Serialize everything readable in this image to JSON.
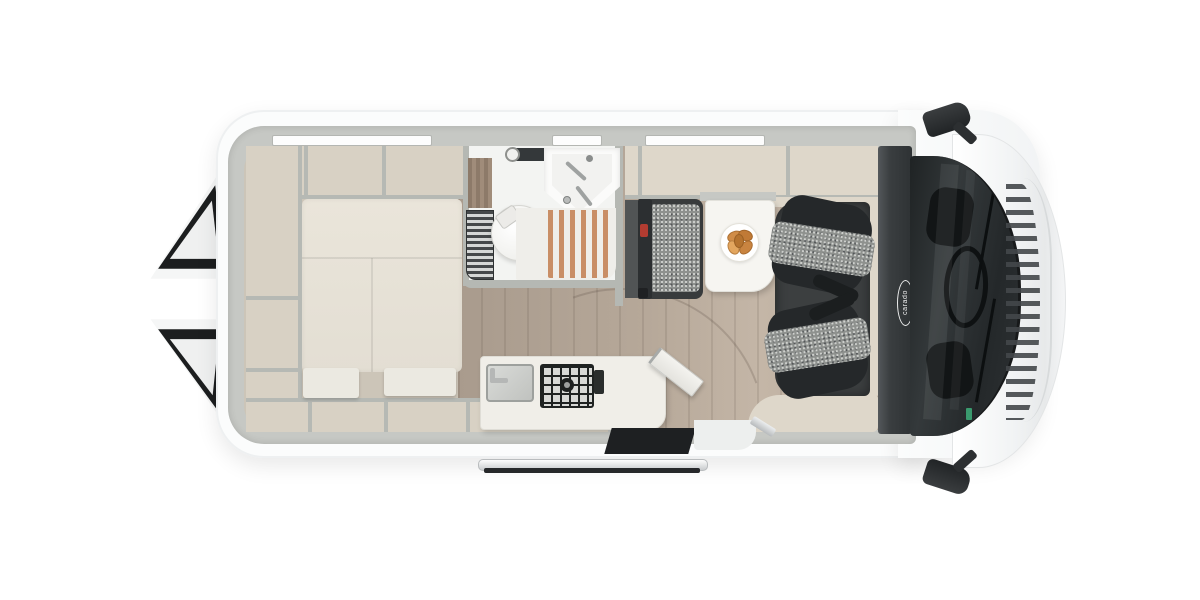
{
  "brand": {
    "logo_text": "carado"
  },
  "palette": {
    "background": "#ffffff",
    "body_white": "#fbfcfc",
    "wall_grey": "#c6c8c4",
    "cabinet_beige": "#d8d1c4",
    "locker_beige": "#ded7ca",
    "mattress_cream": "#e6e1d6",
    "backrest_cream": "#ebe9e1",
    "wood_floor_dark": "#a99b8d",
    "wood_floor_light": "#c4b6a7",
    "bathroom_white": "#f3f4f2",
    "shower_slat_orange": "#c98e66",
    "tambour_dark": "#45484a",
    "bench_charcoal": "#383b3c",
    "seat_fabric_grey": "#8e918e",
    "seat_trim_dark": "#25282a",
    "cab_floor_dark": "#3c3f40",
    "dashboard_charcoal": "#3a3e40",
    "windshield_dark": "#24282a",
    "table_white": "#f6f5f1",
    "croissant_orange": "#cf8a45",
    "belt_buckle_red": "#b23c31",
    "rail_silver": "#d3d6d8",
    "inspection_tag_green": "#3a9a6e"
  },
  "fixtures": [
    "rear-door-open-top-icon",
    "rear-door-open-bottom-icon",
    "van-body-shell",
    "cab-body",
    "hood-icon",
    "roof-window-rear-icon",
    "roof-window-mid-icon",
    "roof-window-front-icon",
    "rear-storage-shelves-icon",
    "wardrobe-column-icon",
    "transverse-bed-icon",
    "bed-backrest-cushions-icon",
    "bathroom-icon",
    "toilet-icon",
    "corner-sink-icon",
    "shower-slatted-floor-icon",
    "tambour-cabinet-icon",
    "kitchen-counter-icon",
    "kitchen-sink-icon",
    "two-burner-hob-icon",
    "folding-table-leaf-icon",
    "dinette-bench-icon",
    "seatbelt-buckle-icon",
    "dining-table-icon",
    "breakfast-plate-icon",
    "swivel-seat-driver-icon",
    "swivel-seat-passenger-icon",
    "cab-footwell-icon",
    "dashboard-icon",
    "brand-logo",
    "windshield-icon",
    "steering-wheel-icon",
    "wiper-icon",
    "cowl-vents-icon",
    "side-mirror-top-icon",
    "side-mirror-bottom-icon",
    "entry-doorway-icon",
    "sliding-door-rail-icon"
  ]
}
